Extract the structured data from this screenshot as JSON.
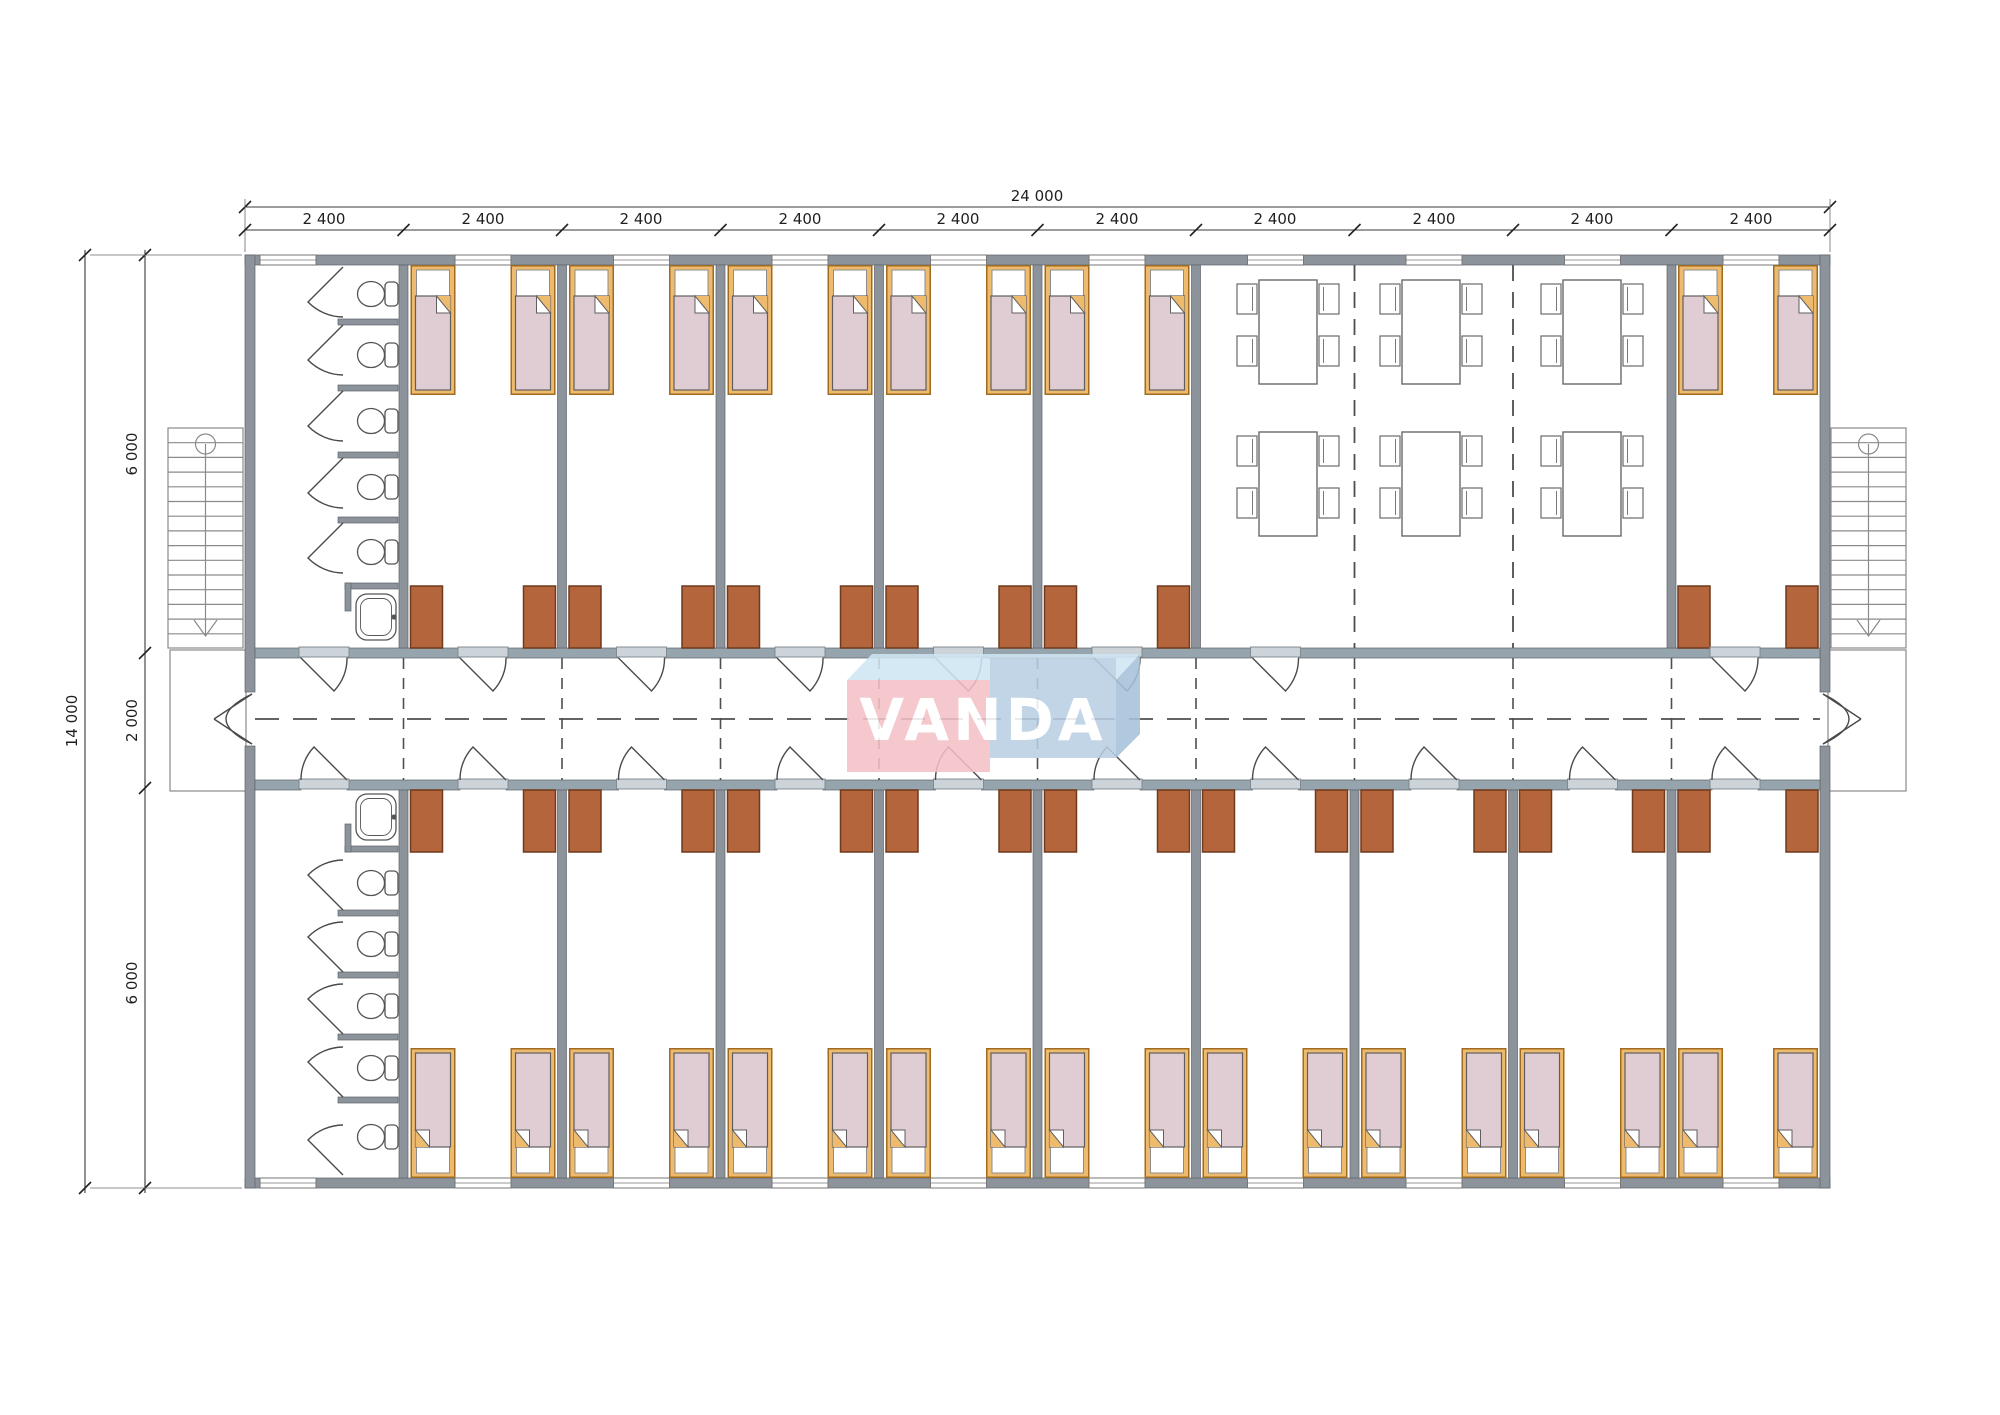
{
  "watermark": {
    "text": "VANDA",
    "colors": {
      "pink_block": "#f3c0c6",
      "blue_block": "#b9cfe4",
      "light_blue_top": "#cfe6f4",
      "shadow_blue_side": "#a6c2da",
      "letters": "#ffffff"
    }
  },
  "dimensions": {
    "top": {
      "total": "24 000",
      "segments": [
        "2 400",
        "2 400",
        "2 400",
        "2 400",
        "2 400",
        "2 400",
        "2 400",
        "2 400",
        "2 400",
        "2 400"
      ]
    },
    "left": {
      "total": "14 000",
      "segments": [
        "6 000",
        "2 000",
        "6 000"
      ]
    }
  },
  "colors": {
    "wall": "#8c939a",
    "corridor_wall": "#95a4ad",
    "threshold_sill": "#ccd4d9",
    "bed_frame": "#eebb6e",
    "bed_mattress": "#e0ccd3",
    "bed_pillow": "#ffffff",
    "wardrobe": "#b4653c",
    "fixture_outline": "#555555",
    "dashed_lines": "#4e4e4e",
    "dimension_text": "#1f1f1f",
    "background": "#ffffff"
  },
  "plan_summary": {
    "modules": 10,
    "dormitory_rooms_top": 6,
    "dormitory_rooms_bottom": 9,
    "beds": 30,
    "wardrobes": 30,
    "dining_tables": 6,
    "toilet_stalls": 10,
    "sinks": 2,
    "staircases": 2
  }
}
